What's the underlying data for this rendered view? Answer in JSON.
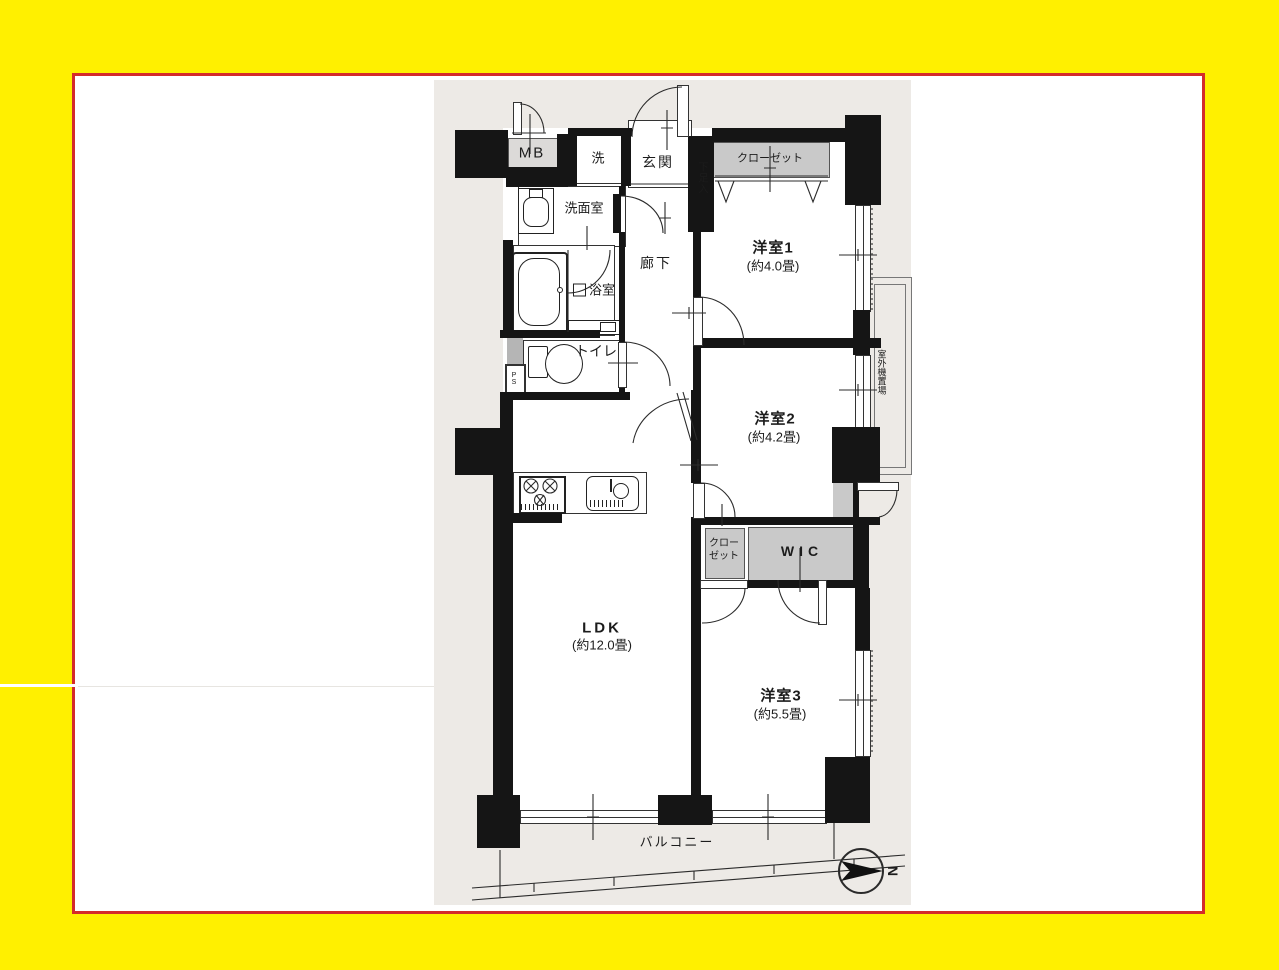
{
  "frame": {
    "background_color": "#FFF000",
    "border_color": "#D42B2B",
    "inner_color": "#FFFFFF"
  },
  "plan": {
    "background_color": "#EDEAE6",
    "wall_color": "#151515",
    "closet_fill_color": "#C9C9C9",
    "labels": {
      "mb": "MB",
      "laundry": "洗",
      "entrance": "玄関",
      "shoe_box": "下足入",
      "closet1": "クローゼット",
      "room1": "洋室1",
      "room1_size": "(約4.0畳)",
      "washroom": "洗面室",
      "corridor": "廊下",
      "bathroom": "浴室",
      "toilet": "トイレ",
      "ps": "PS",
      "room2": "洋室2",
      "room2_size": "(約4.2畳)",
      "outdoor_unit": "室外機置場",
      "ldk": "LDK",
      "ldk_size": "(約12.0畳)",
      "closet2_line1": "クロー",
      "closet2_line2": "ゼット",
      "wic": "WIC",
      "room3": "洋室3",
      "room3_size": "(約5.5畳)",
      "balcony": "バルコニー",
      "north": "N"
    }
  }
}
